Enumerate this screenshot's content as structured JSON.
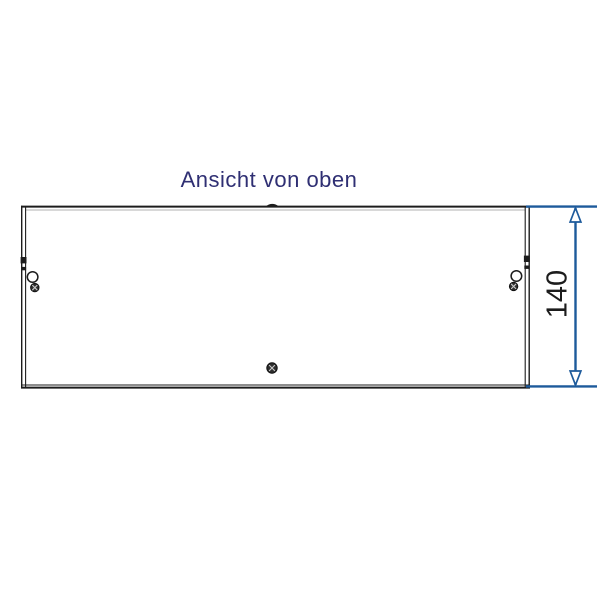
{
  "drawing": {
    "title": "Ansicht von oben",
    "view": "top-view",
    "dimension": {
      "label": "140",
      "orientation": "vertical",
      "side": "right"
    },
    "symbols": [
      "top-tab-marker",
      "left-edge-latch-marks",
      "left-clip-ring",
      "left-edge-screw",
      "right-edge-latch-marks",
      "right-clip-ring",
      "right-edge-screw",
      "center-screw"
    ],
    "colors": {
      "background": "#ffffff",
      "title_text": "#2f2f73",
      "drawing_line": "#1c1c1c",
      "dimension_line": "#1d5a9b"
    }
  }
}
